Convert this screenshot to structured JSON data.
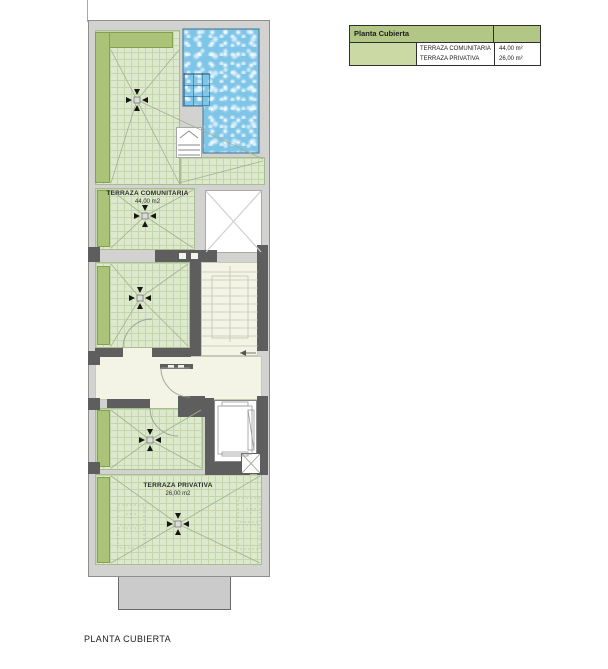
{
  "title": "PLANTA CUBIERTA",
  "legend": {
    "header": "Planta Cubierta",
    "rows": [
      {
        "label": "TERRAZA COMUNITARIA",
        "value": "44,00 m²"
      },
      {
        "label": "TERRAZA PRIVATIVA",
        "value": "26,00 m²"
      }
    ]
  },
  "plan": {
    "terraza_comunitaria": {
      "name": "TERRAZA COMUNITARIA",
      "area": "44,00 m2"
    },
    "terraza_privativa": {
      "name": "TERRAZA PRIVATIVA",
      "area": "26,00 m2"
    }
  },
  "colors": {
    "terrace_fill": "#dde9cd",
    "terrace_grid": "#c4d6ab",
    "planter_green": "#aac378",
    "pool_blue": "#7ec5e8",
    "wall_dark": "#5e5e5e",
    "wall_light": "#d2d2d0",
    "interior_cream": "#f4f4e6",
    "legend_header_green": "#b2c786",
    "legend_swatch_green": "#cbdaa4"
  }
}
